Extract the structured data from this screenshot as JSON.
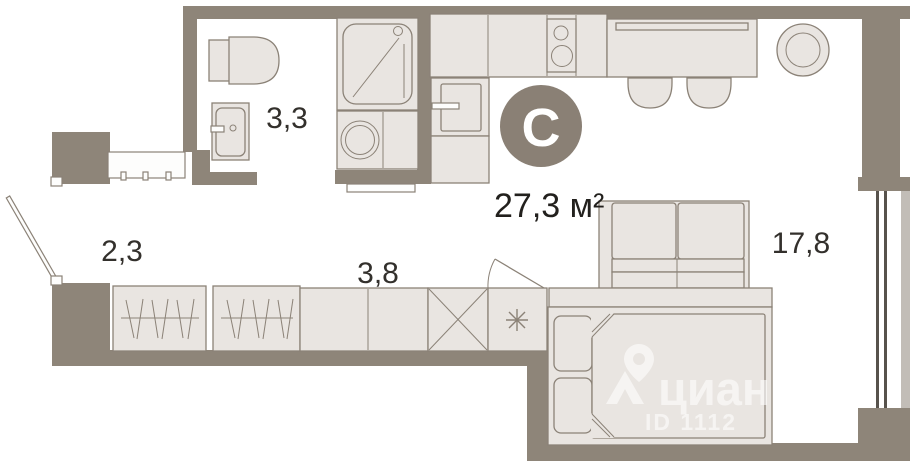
{
  "plan": {
    "unit_type_letter": "С",
    "total_area": "27,3 м²",
    "areas": {
      "bathroom": "3,3",
      "hallway": "2,3",
      "wardrobe_corridor": "3,8",
      "living_room": "17,8"
    },
    "watermark": {
      "brand": "циан",
      "listing_id": "ID 1112"
    },
    "symbols": {
      "vent_shaft_box": "✕",
      "fridge_spot_box": "✳",
      "cian_logo": "map-pin-over-chevron"
    },
    "colors": {
      "wall": "#8e8579",
      "furniture_fill": "#e9e5e1",
      "furniture_stroke": "#8b8277",
      "floor": "#ffffff",
      "label_text": "#33302c",
      "total_text": "#22201d",
      "type_circle_fill": "#8a8075",
      "type_letter": "#ffffff",
      "watermark": "rgba(255,255,255,0.58)",
      "window_line": "#57524c",
      "outer_band": "#c2bdb7"
    }
  }
}
